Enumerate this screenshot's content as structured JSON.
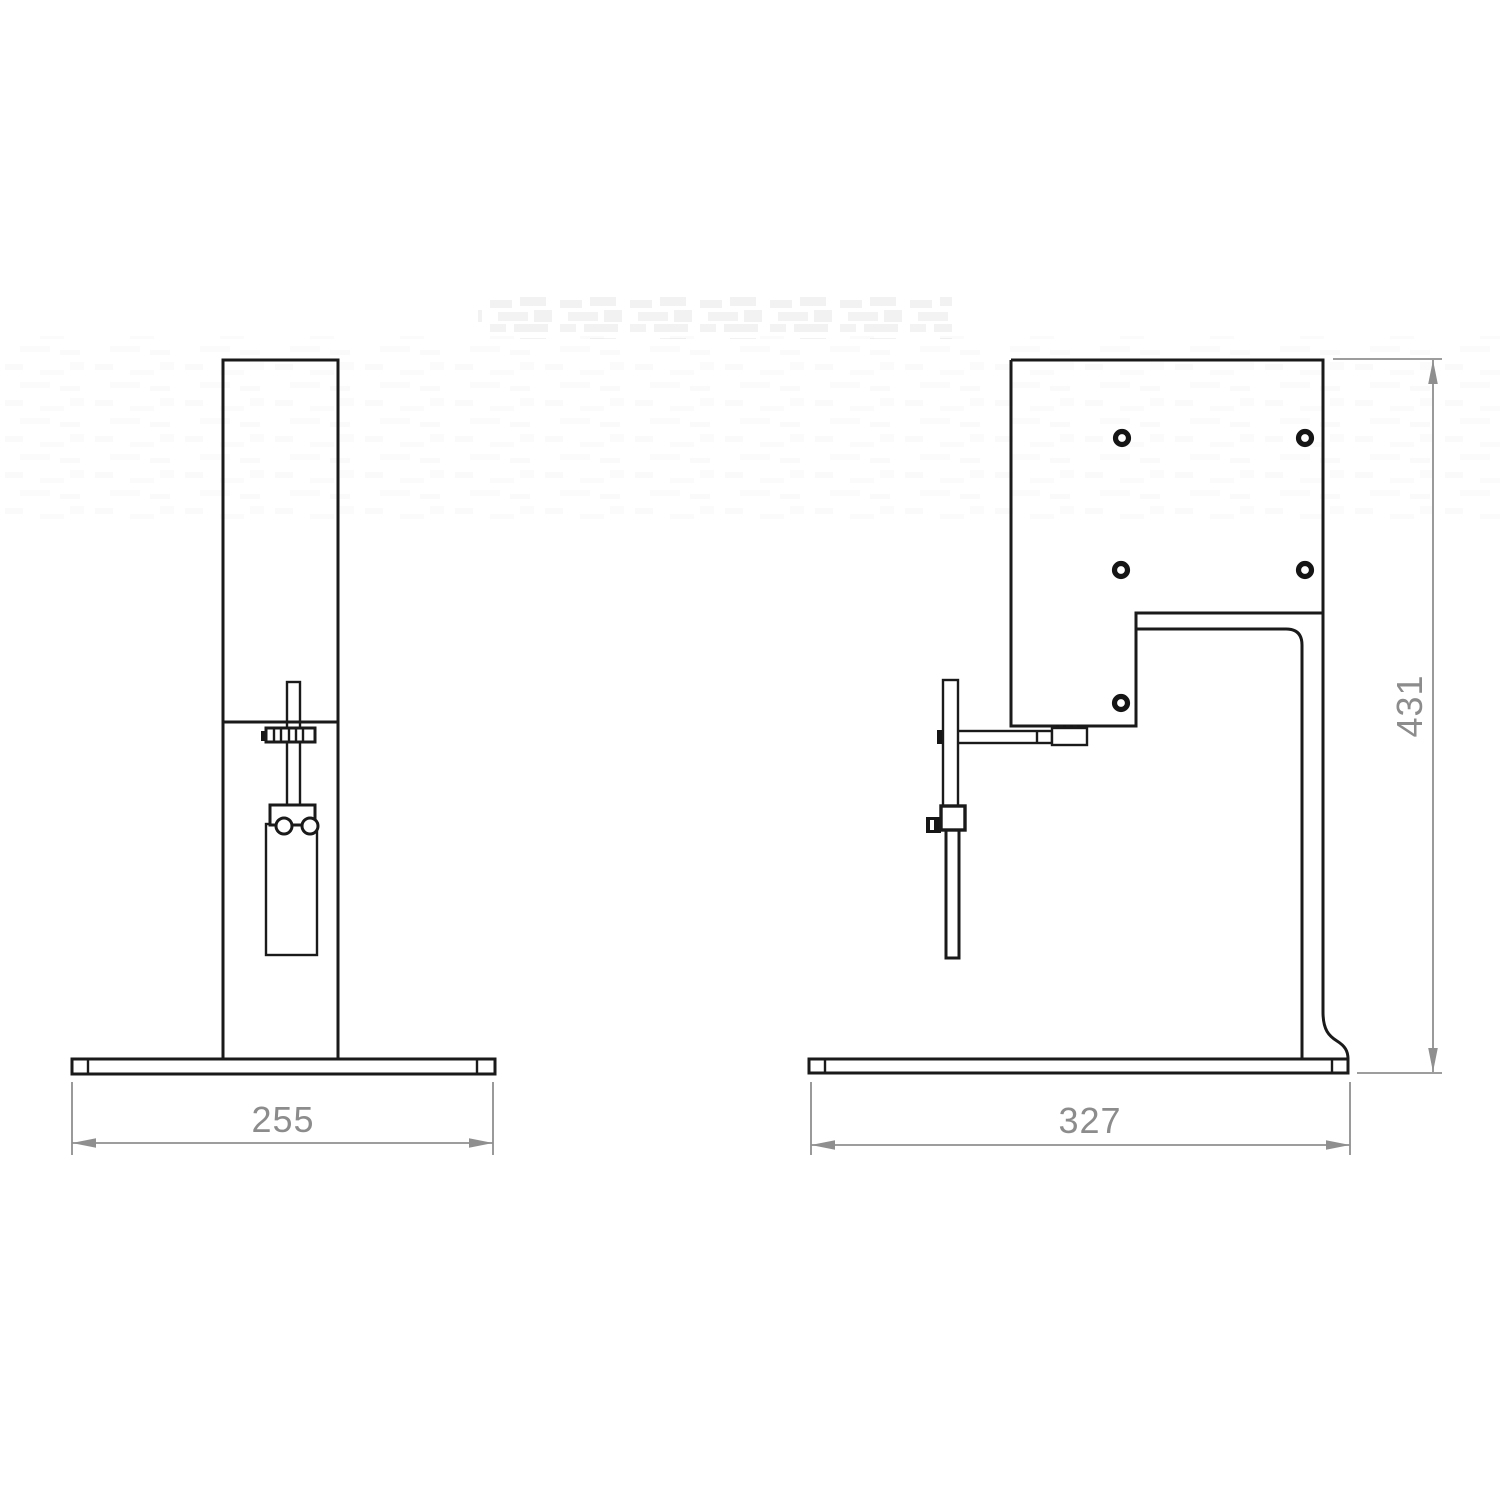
{
  "drawing": {
    "type": "two-view orthographic technical drawing of a bench-top stand",
    "dimensions": {
      "front_base_width": "255",
      "side_base_width": "327",
      "side_height": "431"
    },
    "colors": {
      "outline": "#1a1a1a",
      "dimension": "#8c8c8c",
      "background": "#ffffff",
      "watermark": "#f2f2f2"
    }
  }
}
